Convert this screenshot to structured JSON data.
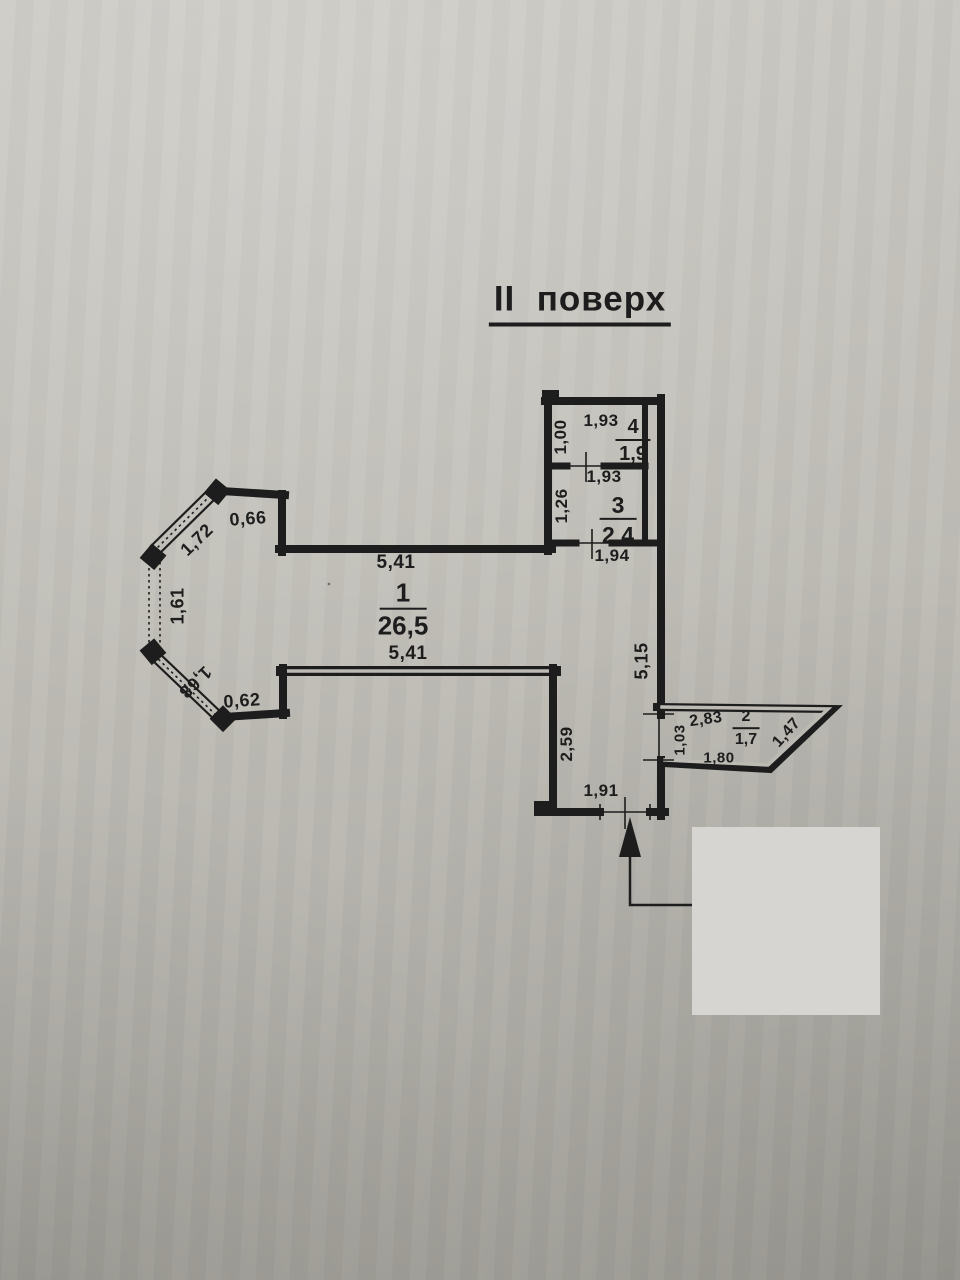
{
  "title": "II  поверх",
  "rooms": [
    {
      "number": "1",
      "area": "26,5"
    },
    {
      "number": "2",
      "area": "1,7"
    },
    {
      "number": "3",
      "area": "2,4"
    },
    {
      "number": "4",
      "area": "1,9"
    }
  ],
  "dimensions": {
    "room4_top": "1,93",
    "room4_left": "1,00",
    "room3_top": "1,93",
    "room3_left": "1,26",
    "room3_bottom": "1,94",
    "room1_top": "5,41",
    "room1_bottom": "5,41",
    "bay_top": "0,66",
    "bay_upper_diagonal": "1,72",
    "bay_side": "1,61",
    "bay_lower_diagonal": "1,68",
    "bay_bottom": "0,62",
    "hall_left": "2,59",
    "right_wall": "5,15",
    "entrance_width": "1,91",
    "balcony_top": "2,83",
    "balcony_left": "1,03",
    "balcony_bottom": "1,80",
    "balcony_diagonal": "1,47"
  },
  "colors": {
    "paper": "#c0beb7",
    "ink": "#1d1d1d",
    "redaction": "#d6d5d2"
  }
}
